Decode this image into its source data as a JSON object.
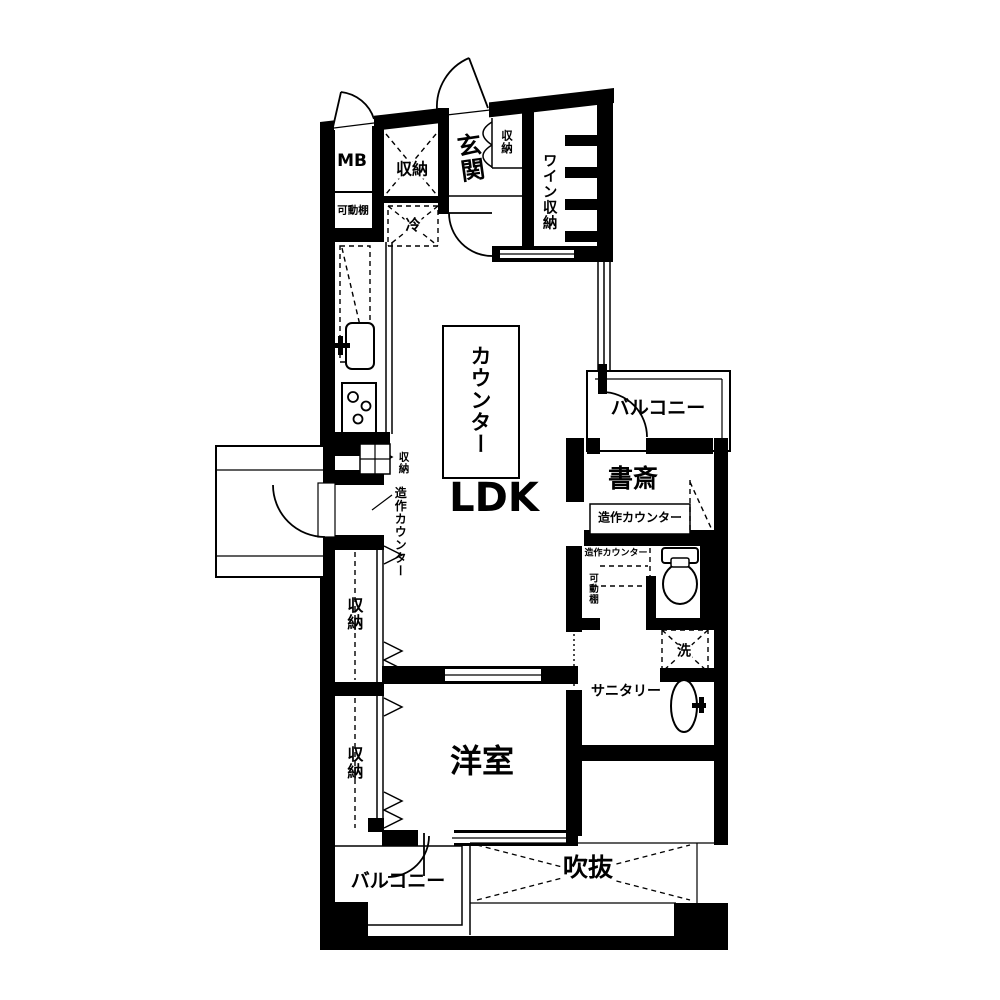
{
  "floor_plan": {
    "colors": {
      "wall": "#000000",
      "floor": "#ffffff"
    },
    "rooms": {
      "mb": "MB",
      "movable_shelf": "可動棚",
      "entry_storage": "収納",
      "fridge": "冷",
      "entrance": "玄関",
      "entrance_storage": "収納",
      "wine_storage": "ワイン収納",
      "counter": "カウンター",
      "ldk": "LDK",
      "kitchen_storage": "収納",
      "built_in_counter_left": "造作カウンター",
      "balcony_right": "バルコニー",
      "study": "書斎",
      "built_in_counter_study": "造作カウンター",
      "built_in_counter_small": "造作カウンター",
      "movable_shelf_small": "可動棚",
      "washer": "洗",
      "sanitary": "サニタリー",
      "closet_upper": "収納",
      "closet_lower": "収納",
      "western_room": "洋室",
      "balcony_bottom": "バルコニー",
      "void": "吹抜"
    },
    "icons": [
      "sink-icon",
      "stove-icon",
      "toilet-icon",
      "washbasin-icon",
      "hatch-icon",
      "door-arc",
      "bifold-door-icon",
      "accordion-door-icon",
      "wine-rack-shelves"
    ]
  }
}
